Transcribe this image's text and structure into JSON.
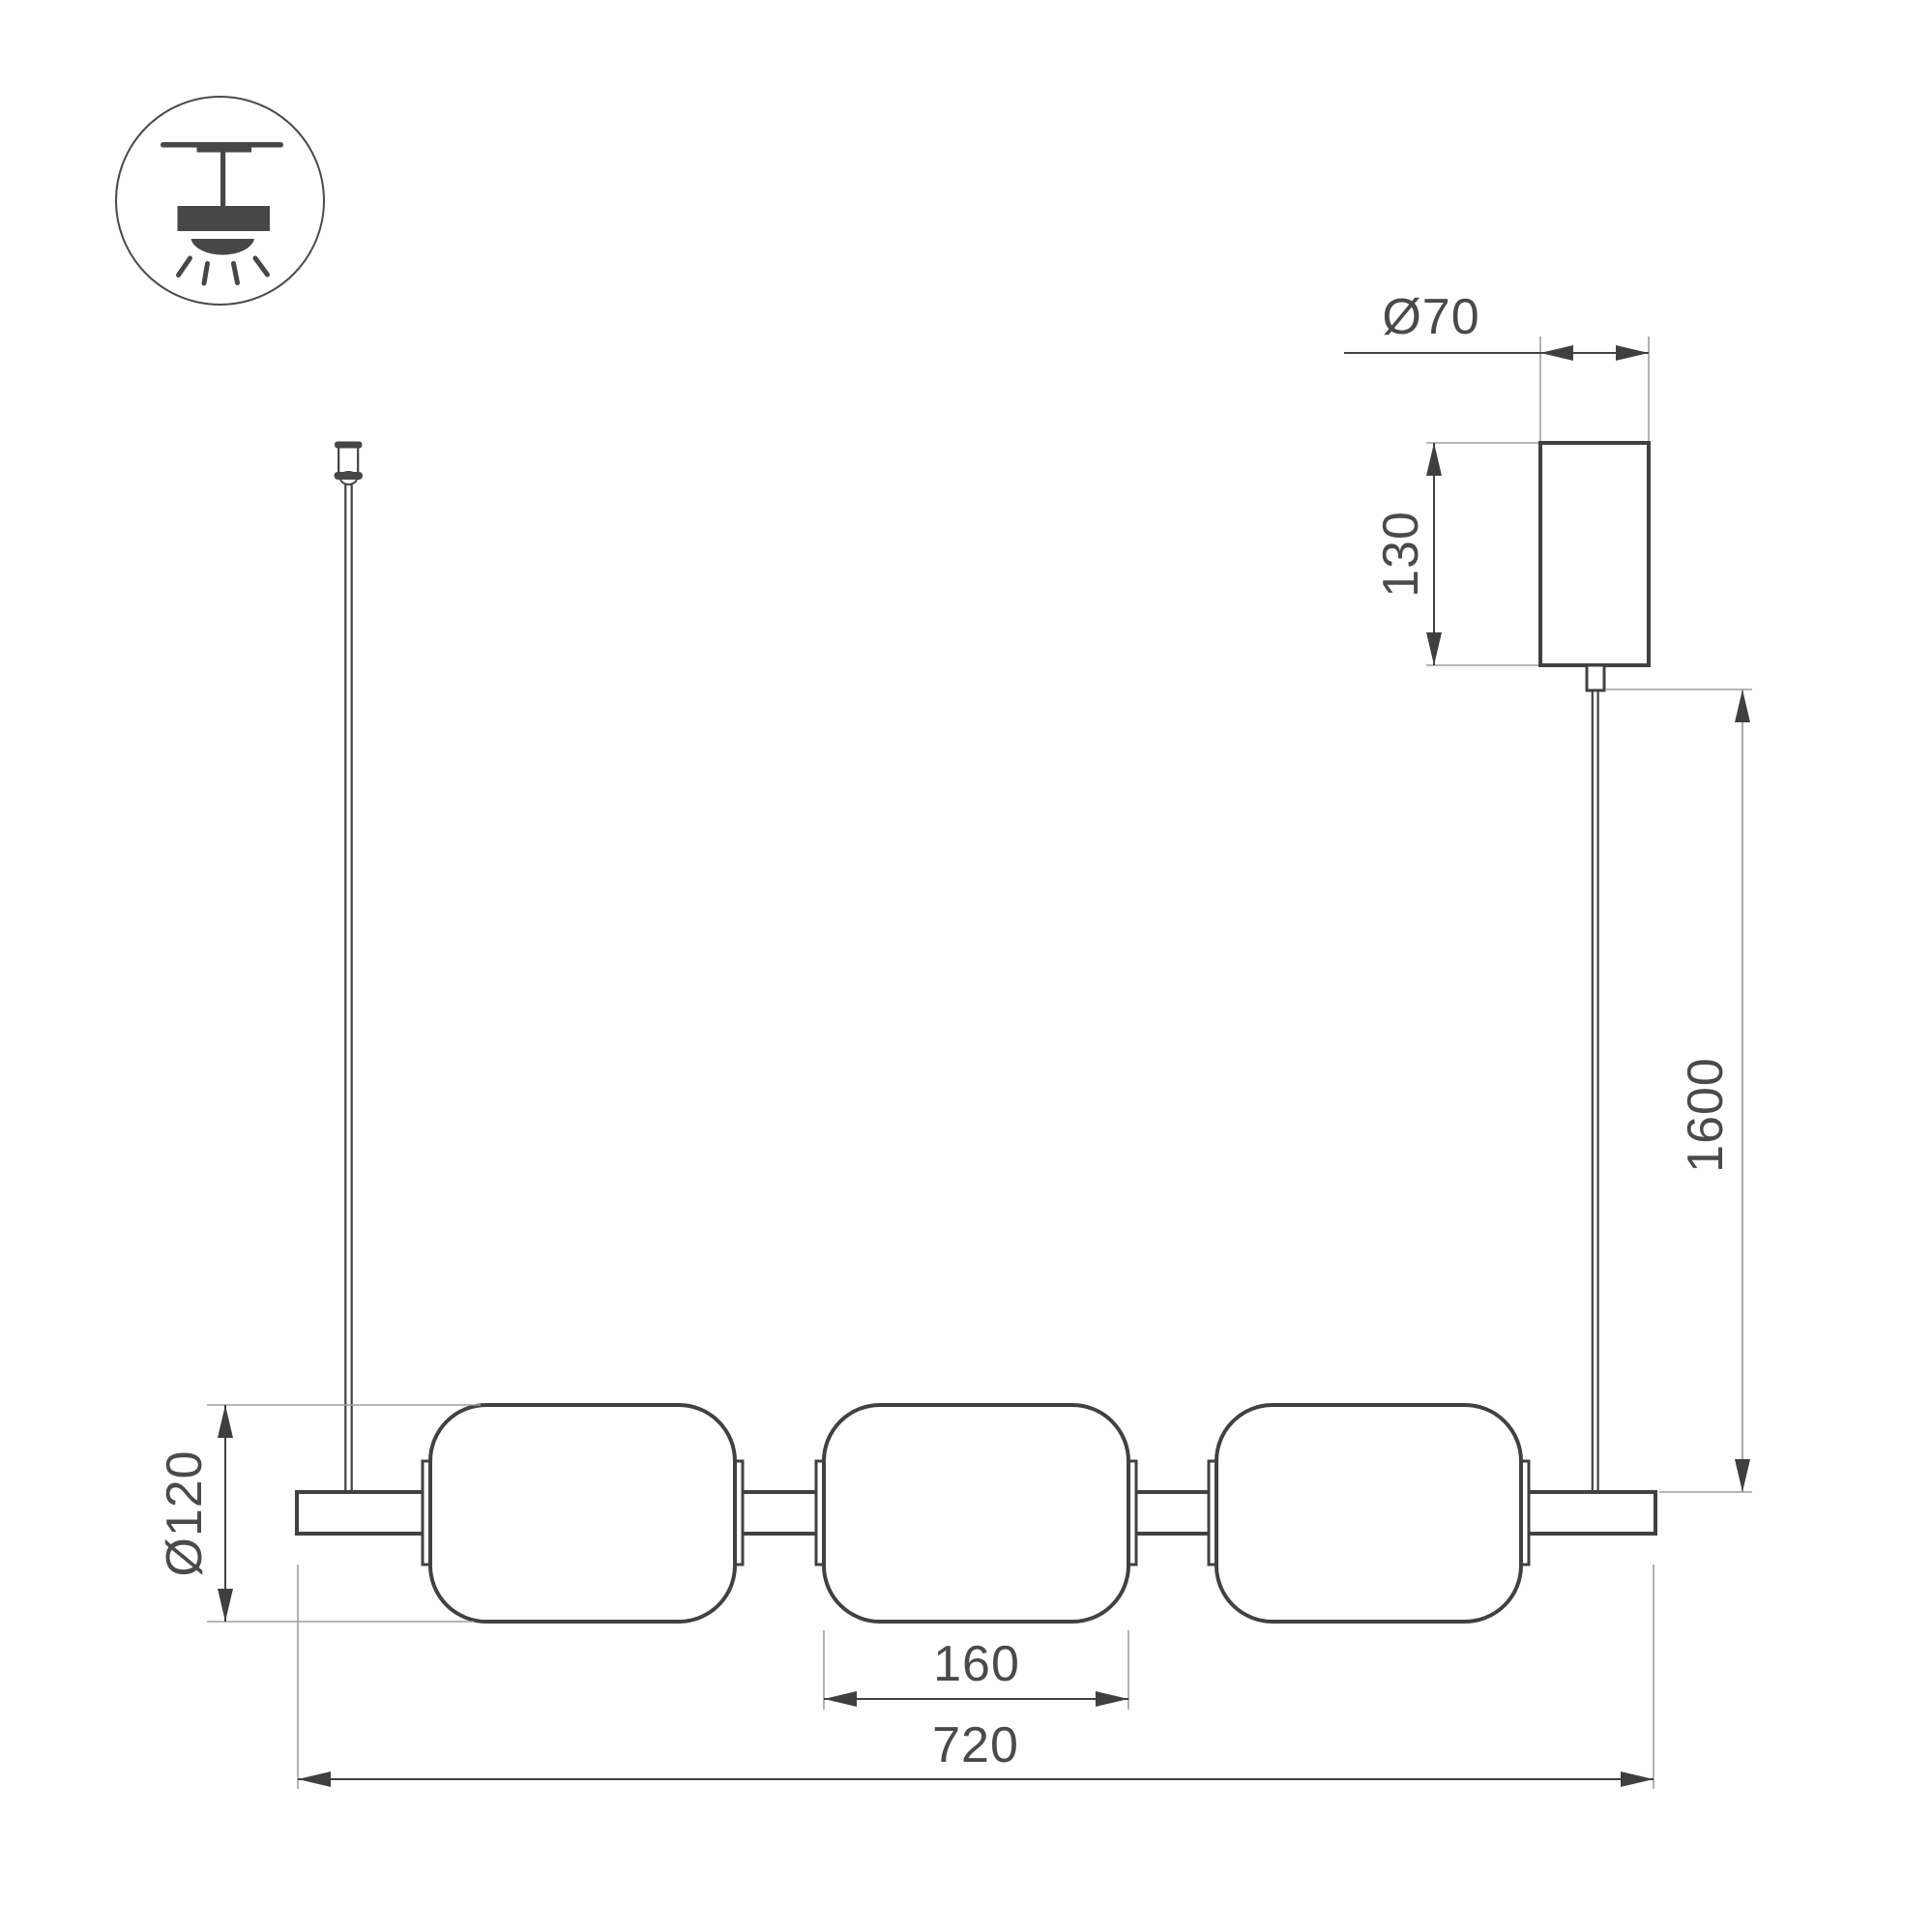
{
  "drawing": {
    "kind": "technical-dimension-drawing",
    "subject": "linear pendant lamp with three capsule shades, suspension cable and ceiling canopy",
    "colors": {
      "line": "#414141",
      "extension_line": "#9e9e9e",
      "text": "#4a4a4a",
      "background": "#ffffff"
    }
  },
  "icon": {
    "type": "ceiling-surface-pendant-mount"
  },
  "dims": {
    "canopy_diameter": "Ø70",
    "canopy_height": "130",
    "suspension_length": "1600",
    "shade_diameter": "Ø120",
    "shade_width": "160",
    "fixture_length": "720"
  }
}
